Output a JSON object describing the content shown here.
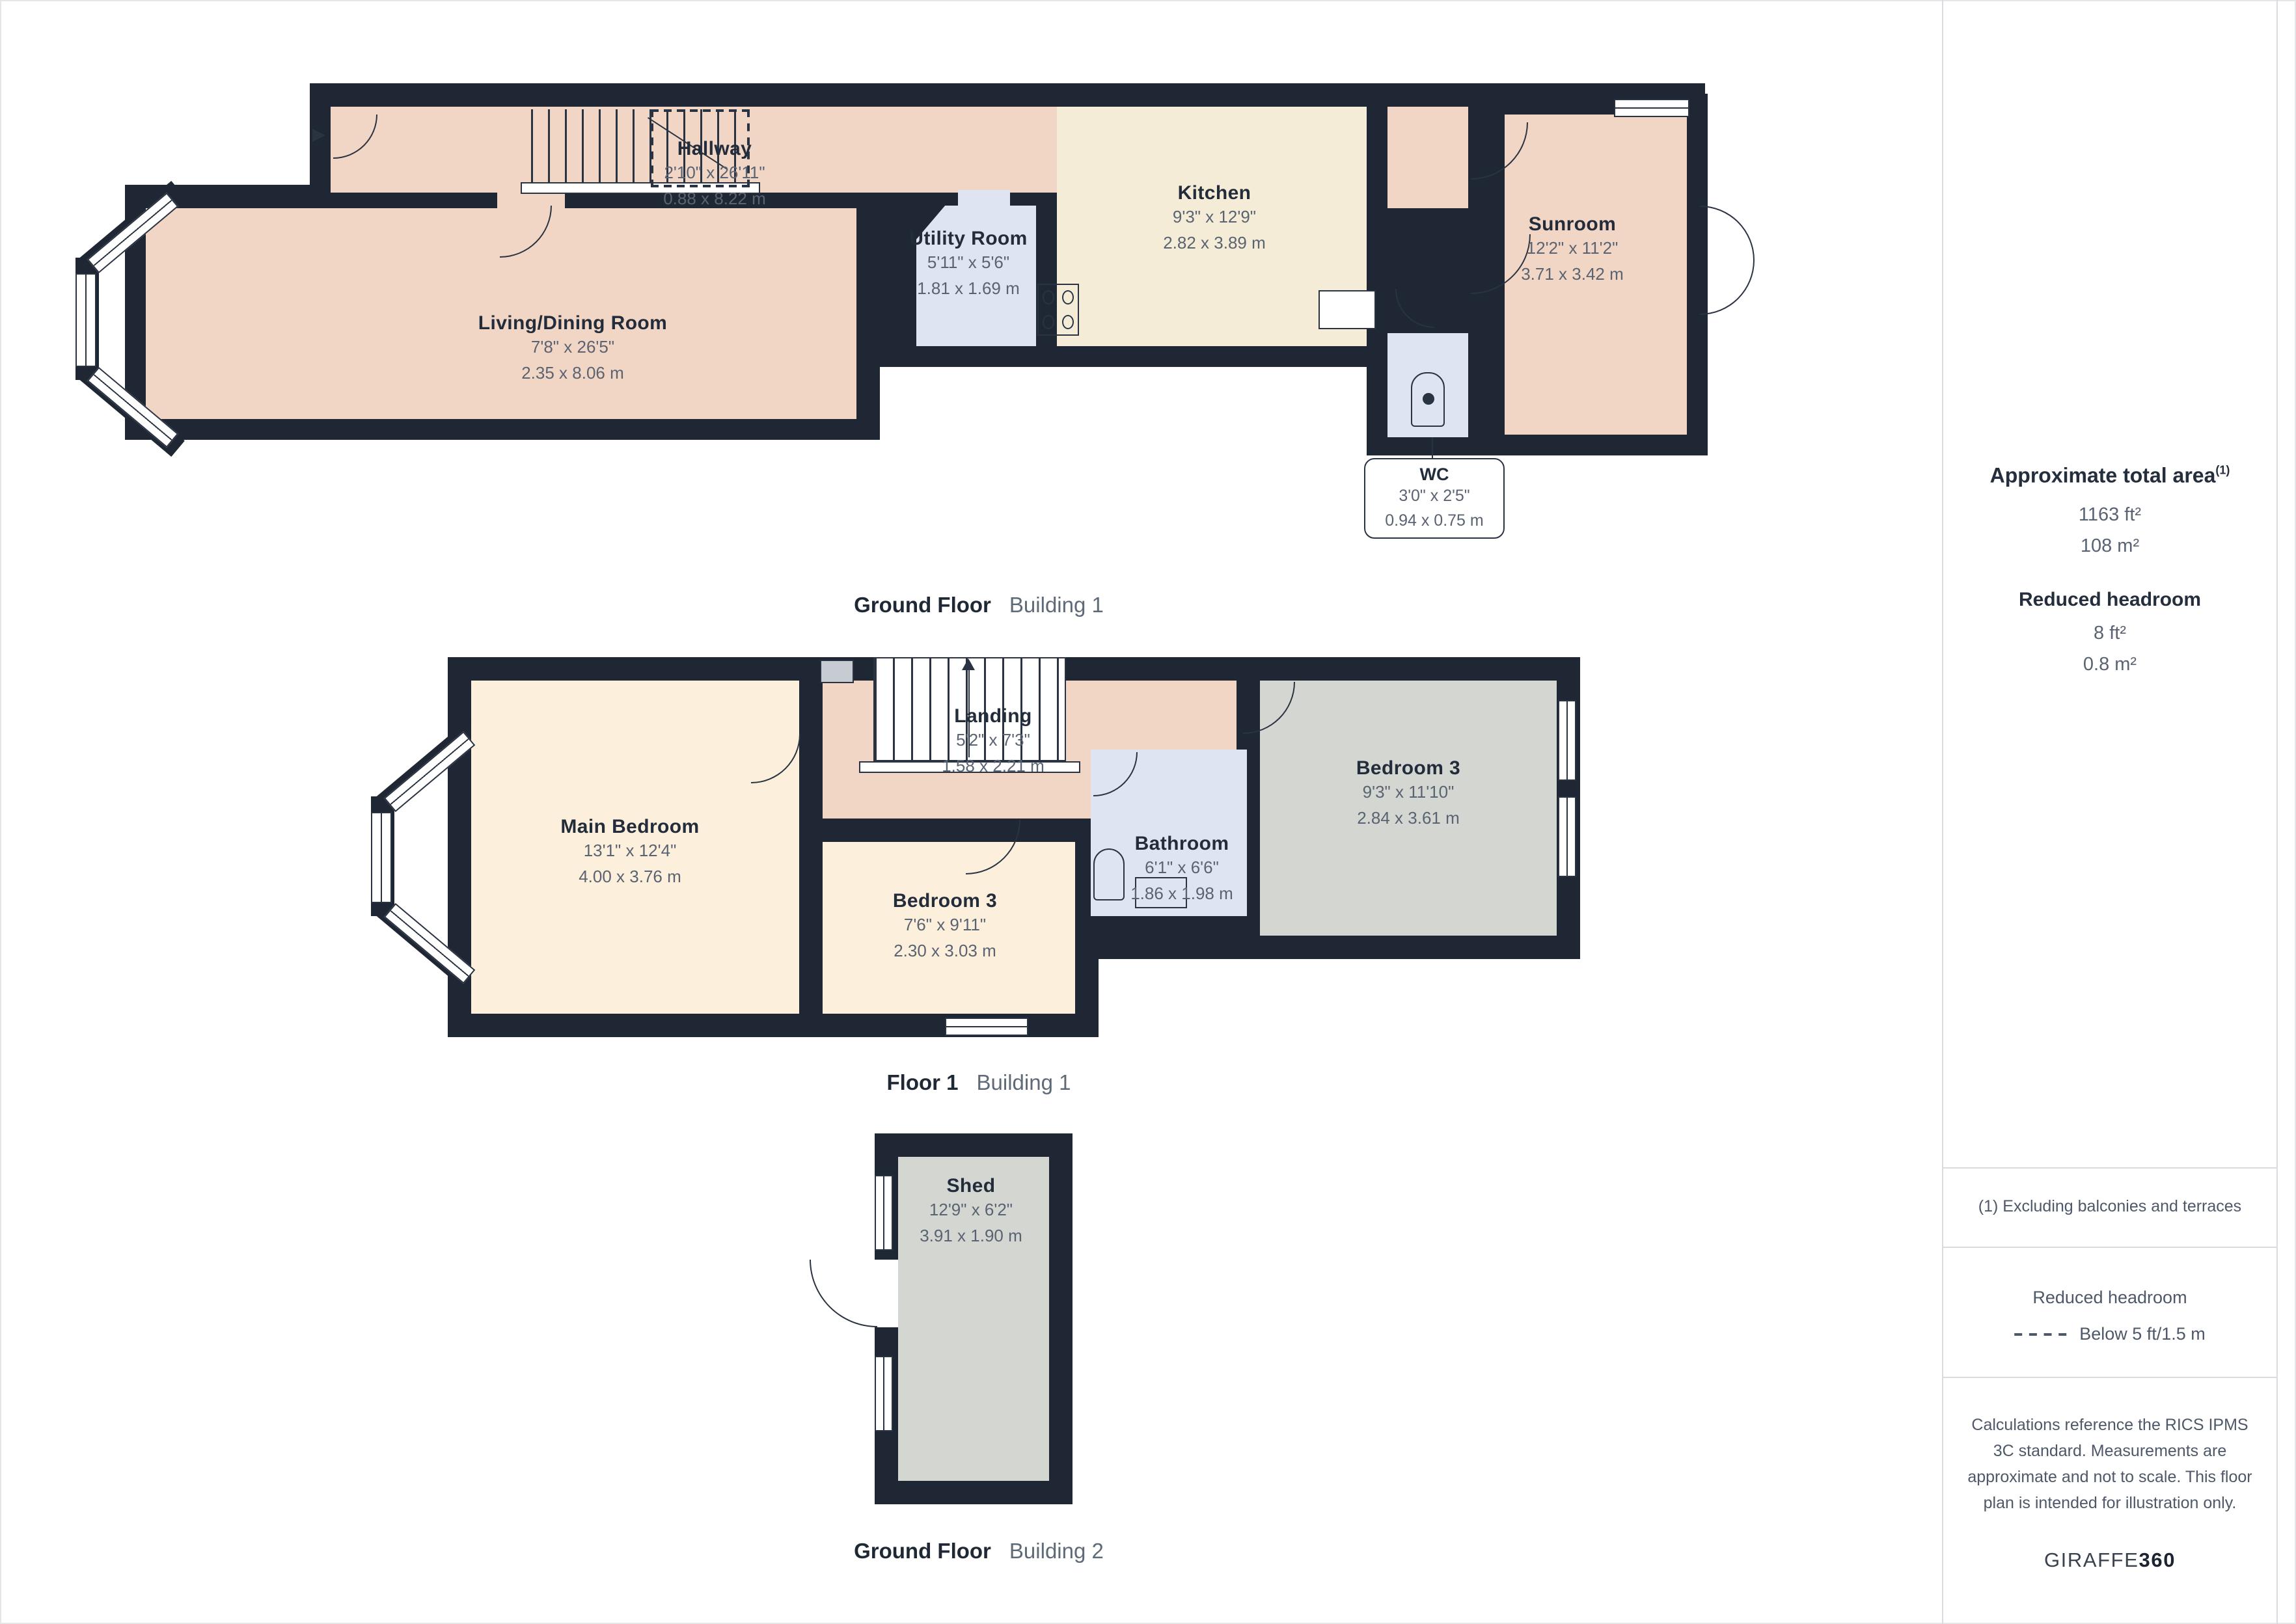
{
  "plans": [
    {
      "floor_label": "Ground Floor",
      "building_label": "Building 1",
      "rooms": [
        {
          "name": "Hallway",
          "imperial": "2'10\" x 26'11\"",
          "metric": "0.88 x 8.22 m"
        },
        {
          "name": "Living/Dining Room",
          "imperial": "7'8\" x 26'5\"",
          "metric": "2.35 x 8.06 m"
        },
        {
          "name": "Utility Room",
          "imperial": "5'11\" x 5'6\"",
          "metric": "1.81 x 1.69 m"
        },
        {
          "name": "Kitchen",
          "imperial": "9'3\" x 12'9\"",
          "metric": "2.82 x 3.89 m"
        },
        {
          "name": "Sunroom",
          "imperial": "12'2\" x 11'2\"",
          "metric": "3.71 x 3.42 m"
        },
        {
          "name": "WC",
          "imperial": "3'0\" x 2'5\"",
          "metric": "0.94 x 0.75 m"
        }
      ]
    },
    {
      "floor_label": "Floor 1",
      "building_label": "Building 1",
      "rooms": [
        {
          "name": "Main Bedroom",
          "imperial": "13'1\" x 12'4\"",
          "metric": "4.00 x 3.76 m"
        },
        {
          "name": "Landing",
          "imperial": "5'2\" x 7'3\"",
          "metric": "1.58 x 2.21 m"
        },
        {
          "name": "Bedroom 3",
          "imperial": "7'6\" x 9'11\"",
          "metric": "2.30 x 3.03 m"
        },
        {
          "name": "Bathroom",
          "imperial": "6'1\" x 6'6\"",
          "metric": "1.86 x 1.98 m"
        },
        {
          "name": "Bedroom 3",
          "imperial": "9'3\" x 11'10\"",
          "metric": "2.84 x 3.61 m"
        }
      ]
    },
    {
      "floor_label": "Ground Floor",
      "building_label": "Building 2",
      "rooms": [
        {
          "name": "Shed",
          "imperial": "12'9\" x 6'2\"",
          "metric": "3.91 x 1.90 m"
        }
      ]
    }
  ],
  "sidebar": {
    "total_area_heading": "Approximate total area",
    "footnote_marker": "(1)",
    "total_area_ft": "1163 ft²",
    "total_area_m": "108 m²",
    "reduced_headroom_heading": "Reduced headroom",
    "reduced_headroom_ft": "8 ft²",
    "reduced_headroom_m": "0.8 m²",
    "footnote": "(1) Excluding balconies and terraces",
    "legend_heading": "Reduced headroom",
    "legend_item": "Below 5 ft/1.5 m",
    "disclaimer": "Calculations reference the RICS IPMS 3C standard. Measurements are approximate and not to scale. This floor plan is intended for illustration only.",
    "brand_name": "GIRAFFE",
    "brand_suffix": "360"
  },
  "colors": {
    "wall": "#1f2734",
    "room_peach": "#f2d6c5",
    "room_cream": "#f4ecd7",
    "room_ivory": "#fcefdc",
    "room_blue": "#dfe4f2",
    "room_gray": "#d4d6d2",
    "title_text": "#232c3a",
    "dim_text": "#5a6372"
  }
}
